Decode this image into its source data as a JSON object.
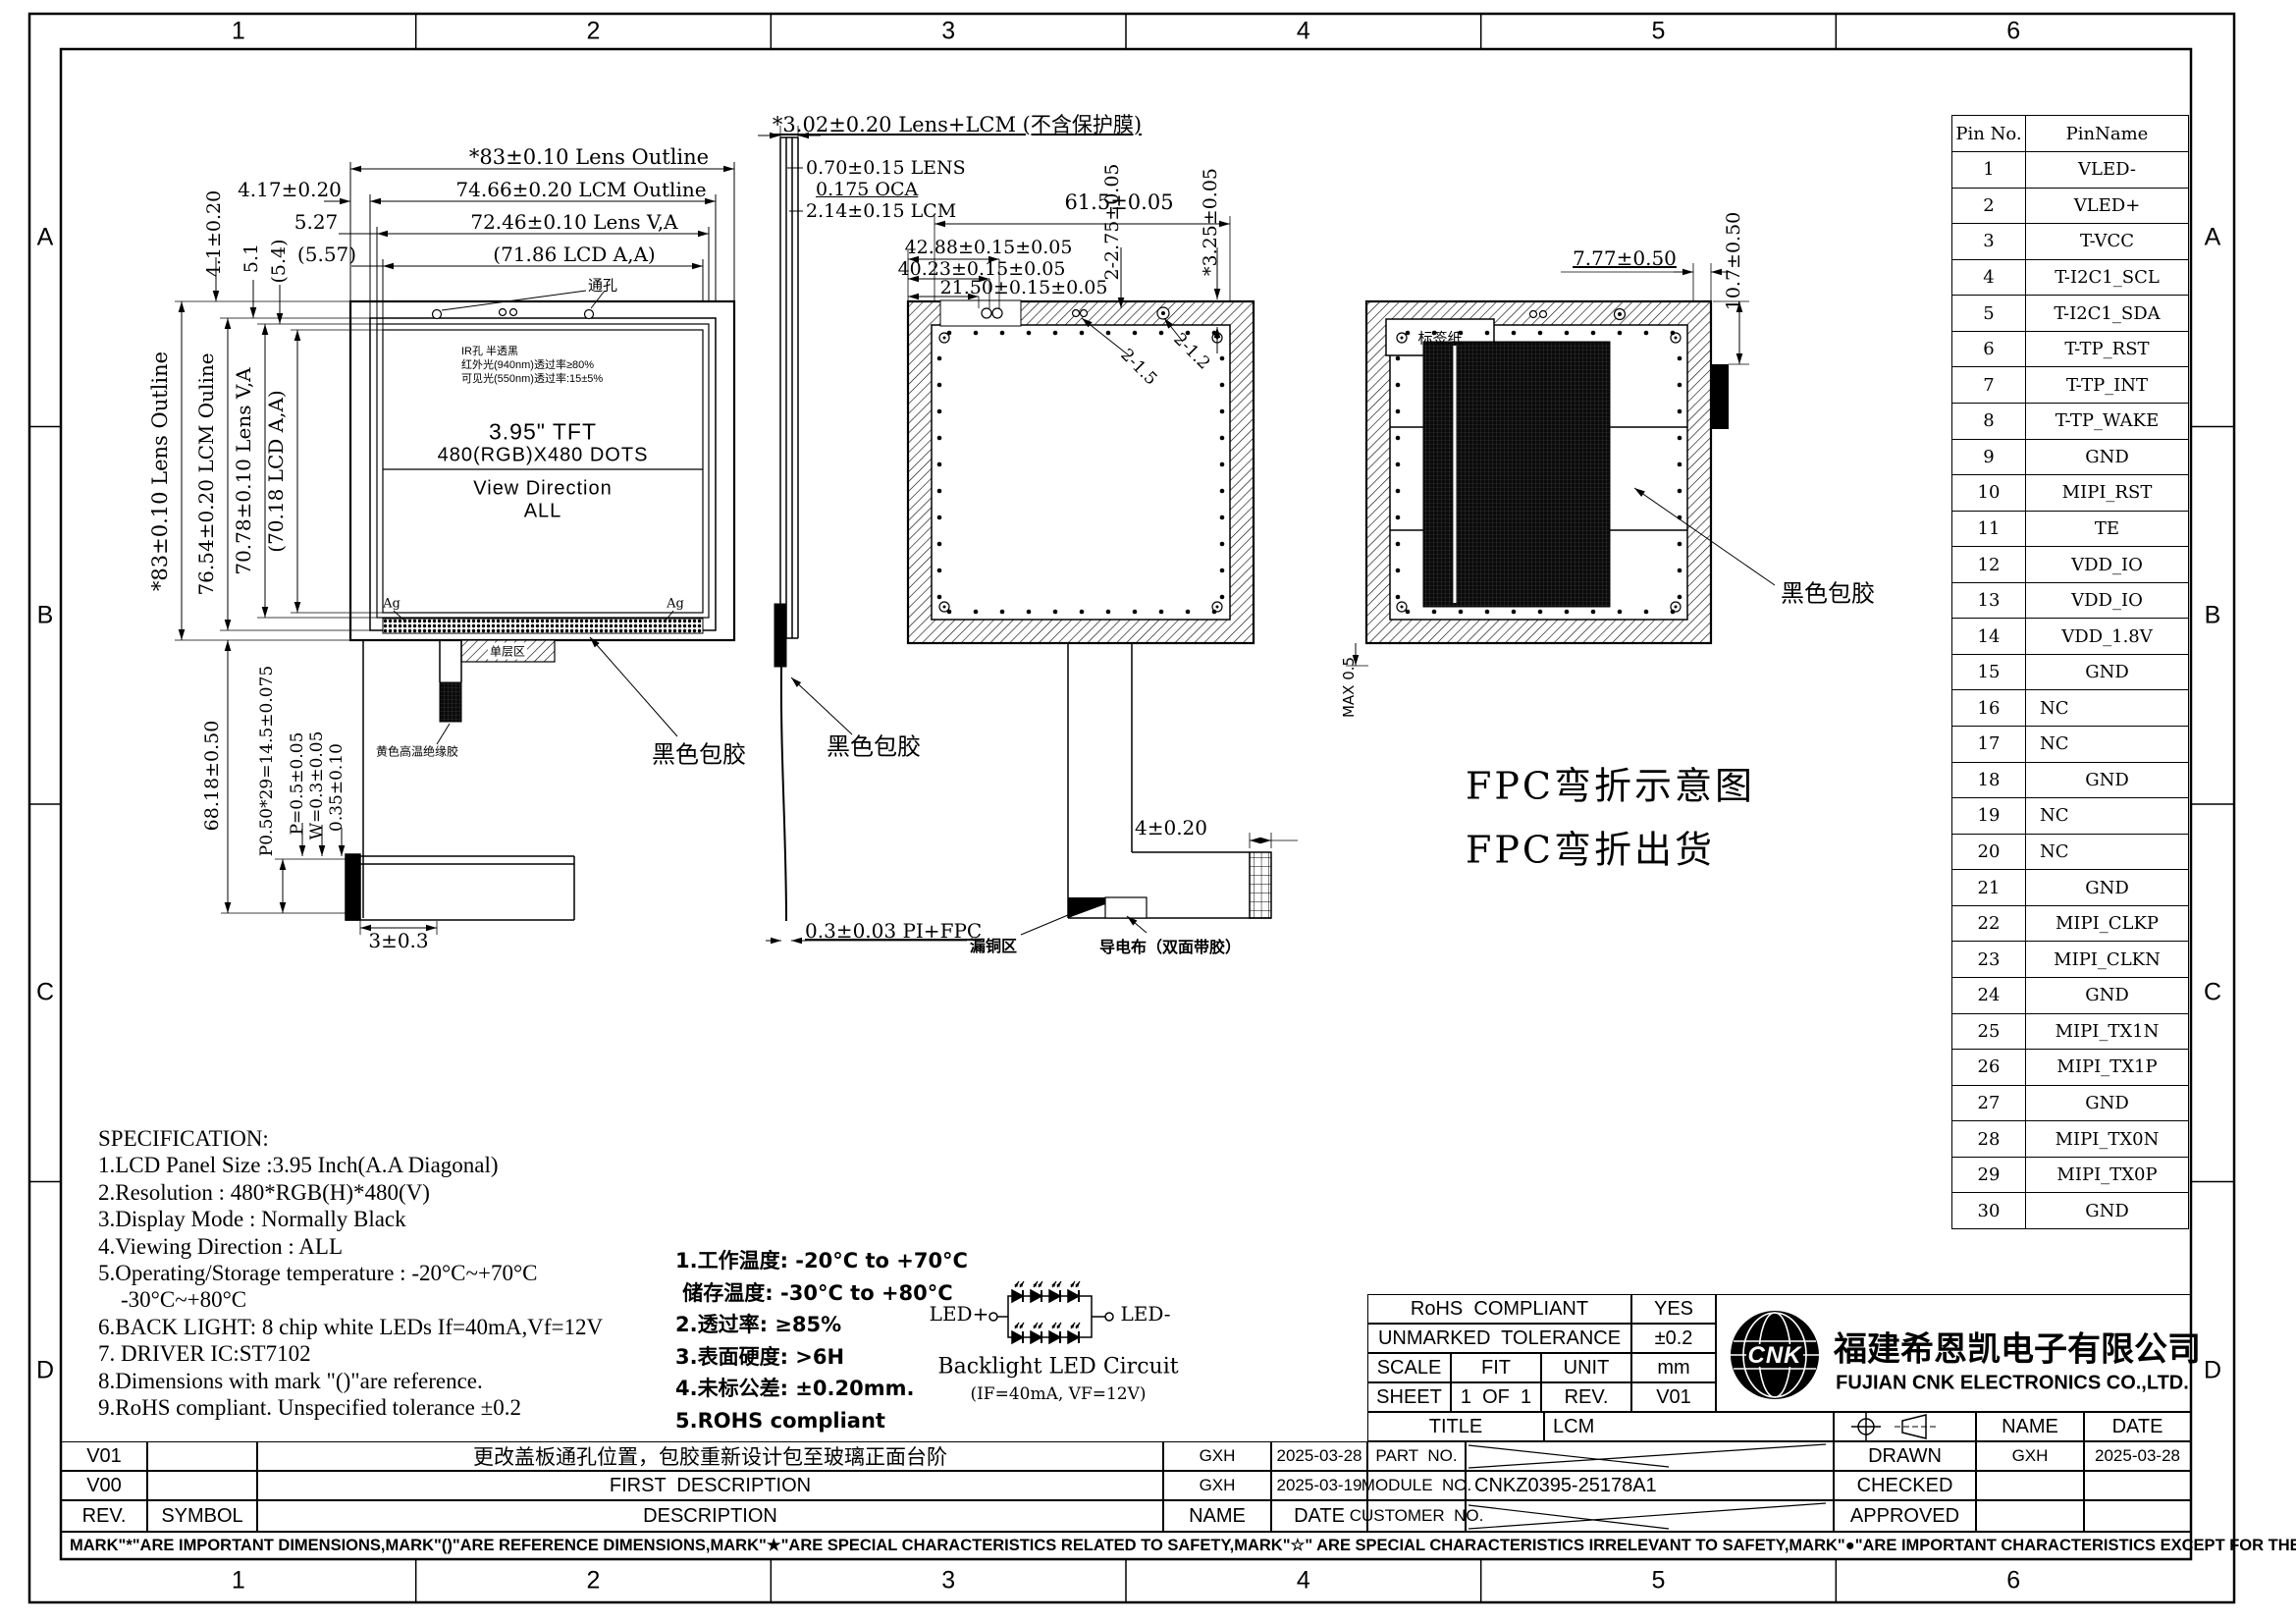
{
  "frame": {
    "cols": [
      "1",
      "2",
      "3",
      "4",
      "5",
      "6"
    ],
    "rows": [
      "A",
      "B",
      "C",
      "D"
    ]
  },
  "front": {
    "dim_lens_outline_h": "*83±0.10 Lens Outline",
    "dim_lcm_outline_h": "74.66±0.20 LCM Outline",
    "dim_lens_va_h": "72.46±0.10 Lens V,A",
    "dim_lcd_aa_h": "(71.86 LCD A,A)",
    "dim_417": "4.17±0.20",
    "dim_527": "5.27",
    "dim_557": "(5.57)",
    "dim_41": "4.1±0.20",
    "dim_51": "5.1",
    "dim_54": "(5.4)",
    "dim_lens_outline_v": "*83±0.10 Lens Outline",
    "dim_lcm_outline_v": "76.54±0.20 LCM Ouline",
    "dim_lens_va_v": "70.78±0.10 Lens V,A",
    "dim_lcd_aa_v": "(70.18 LCD A,A)",
    "dim_6818": "68.18±0.50",
    "dim_p050": "P0.50*29=14.5±0.075",
    "dim_p05": "P=0.5±0.05",
    "dim_w03": "W=0.3±0.05",
    "dim_035": "0.35±0.10",
    "dim_303": "3±0.3",
    "tft_line1": "3.95\" TFT",
    "tft_line2": "480(RGB)X480 DOTS",
    "view_dir1": "View Direction",
    "view_dir2": "ALL",
    "ir_note1": "IR孔 半透黑",
    "ir_note2": "红外光(940nm)透过率≥80%",
    "ir_note3": "可见光(550nm)透过率:15±5%",
    "through_hole": "通孔",
    "ag": "Ag",
    "single_layer": "单层区",
    "yellow_tape": "黄色高温绝缘胶",
    "black_glue": "黑色包胶"
  },
  "side": {
    "dim_total": "*3.02±0.20 Lens+LCM (不含保护膜)",
    "dim_lens": "0.70±0.15 LENS",
    "dim_oca": "0.175 OCA",
    "dim_lcm": "2.14±0.15 LCM",
    "black_glue": "黑色包胶",
    "dim_pifpc": "0.3±0.03 PI+FPC"
  },
  "back": {
    "dim_615": "61.5±0.05",
    "dim_4288": "42.88±0.15±0.05",
    "dim_4023": "40.23±0.15±0.05",
    "dim_2150": "21.50±0.15±0.05",
    "dim_2275": "2-2.75±0.05",
    "dim_325": "*3.25±0.05",
    "dim_215": "2-1.5",
    "dim_212": "2-1.2",
    "dim_4": "4±0.20",
    "copper": "漏铜区",
    "cloth": "导电布（双面带胶）"
  },
  "bent": {
    "label_paper": "标签纸",
    "dim_777": "7.77±0.50",
    "dim_107": "10.7±0.50",
    "dim_max": "MAX 0.5",
    "black_glue": "黑色包胶",
    "fpc_line1": "FPC弯折示意图",
    "fpc_line2": "FPC弯折出货"
  },
  "pin_table": {
    "col1": "Pin No.",
    "col2": "PinName",
    "rows": [
      [
        "1",
        "VLED-"
      ],
      [
        "2",
        "VLED+"
      ],
      [
        "3",
        "T-VCC"
      ],
      [
        "4",
        "T-I2C1_SCL"
      ],
      [
        "5",
        "T-I2C1_SDA"
      ],
      [
        "6",
        "T-TP_RST"
      ],
      [
        "7",
        "T-TP_INT"
      ],
      [
        "8",
        "T-TP_WAKE"
      ],
      [
        "9",
        "GND"
      ],
      [
        "10",
        "MIPI_RST"
      ],
      [
        "11",
        "TE"
      ],
      [
        "12",
        "VDD_IO"
      ],
      [
        "13",
        "VDD_IO"
      ],
      [
        "14",
        "VDD_1.8V"
      ],
      [
        "15",
        "GND"
      ],
      [
        "16",
        "NC"
      ],
      [
        "17",
        "NC"
      ],
      [
        "18",
        "GND"
      ],
      [
        "19",
        "NC"
      ],
      [
        "20",
        "NC"
      ],
      [
        "21",
        "GND"
      ],
      [
        "22",
        "MIPI_CLKP"
      ],
      [
        "23",
        "MIPI_CLKN"
      ],
      [
        "24",
        "GND"
      ],
      [
        "25",
        "MIPI_TX1N"
      ],
      [
        "26",
        "MIPI_TX1P"
      ],
      [
        "27",
        "GND"
      ],
      [
        "28",
        "MIPI_TX0N"
      ],
      [
        "29",
        "MIPI_TX0P"
      ],
      [
        "30",
        "GND"
      ]
    ]
  },
  "spec": {
    "title": "SPECIFICATION:",
    "lines": [
      "1.LCD Panel Size :3.95 Inch(A.A Diagonal)",
      "2.Resolution : 480*RGB(H)*480(V)",
      "3.Display Mode : Normally Black",
      "4.Viewing Direction : ALL",
      "5.Operating/Storage temperature : -20°C~+70°C",
      "    -30°C~+80°C",
      "6.BACK LIGHT: 8 chip white LEDs If=40mA,Vf=12V",
      "7. DRIVER IC:ST7102",
      "8.Dimensions with mark \"()\"are reference.",
      "9.RoHS compliant. Unspecified tolerance ±0.2"
    ]
  },
  "notes_cn": {
    "lines": [
      "1.工作温度: -20°C to +70°C",
      " 储存温度: -30°C to +80°C",
      "2.透过率: ≥85%",
      "3.表面硬度: >6H",
      "4.未标公差: ±0.20mm.",
      "5.ROHS compliant"
    ]
  },
  "led": {
    "pos": "LED+",
    "neg": "LED-",
    "caption": "Backlight LED Circuit",
    "sub": "(IF=40mA, VF=12V)"
  },
  "info_table": {
    "rohs_label": "RoHS  COMPLIANT",
    "rohs_value": "YES",
    "tol_label": "UNMARKED  TOLERANCE",
    "tol_value": "±0.2",
    "scale_label": "SCALE",
    "scale_value": "FIT",
    "unit_label": "UNIT",
    "unit_value": "mm",
    "sheet_label": "SHEET",
    "sheet_value": "1  OF  1",
    "rev_label": "REV.",
    "rev_value": "V01"
  },
  "company": {
    "cn": "福建希恩凯电子有限公司",
    "en": "FUJIAN CNK ELECTRONICS CO.,LTD.",
    "logo": "CNK"
  },
  "title_block": {
    "title_label": "TITLE",
    "title_value": "LCM",
    "part_label": "PART  NO.",
    "module_label": "MODULE  NO.",
    "module_value": "CNKZ0395-25178A1",
    "customer_label": "CUSTOMER  NO.",
    "name_label": "NAME",
    "date_label": "DATE",
    "drawn_label": "DRAWN",
    "drawn_name": "GXH",
    "drawn_date": "2025-03-28",
    "checked_label": "CHECKED",
    "approved_label": "APPROVED"
  },
  "revisions": {
    "header": {
      "rev": "REV.",
      "symbol": "SYMBOL",
      "desc": "DESCRIPTION",
      "name": "NAME",
      "date": "DATE"
    },
    "rows": [
      {
        "rev": "V01",
        "symbol": "",
        "desc": "更改盖板通孔位置，包胶重新设计包至玻璃正面台阶",
        "name": "GXH",
        "date": "2025-03-28"
      },
      {
        "rev": "V00",
        "symbol": "",
        "desc": "FIRST  DESCRIPTION",
        "name": "GXH",
        "date": "2025-03-19"
      }
    ]
  },
  "disclaimer": "MARK\"*\"ARE IMPORTANT DIMENSIONS,MARK\"()\"ARE REFERENCE DIMENSIONS,MARK\"★\"ARE SPECIAL CHARACTERISTICS RELATED TO SAFETY,MARK\"☆\" ARE SPECIAL CHARACTERISTICS IRRELEVANT TO SAFETY,MARK\"●\"ARE IMPORTANT CHARACTERISTICS EXCEPT FOR THE SPECIAL CHARACTERISTICS."
}
